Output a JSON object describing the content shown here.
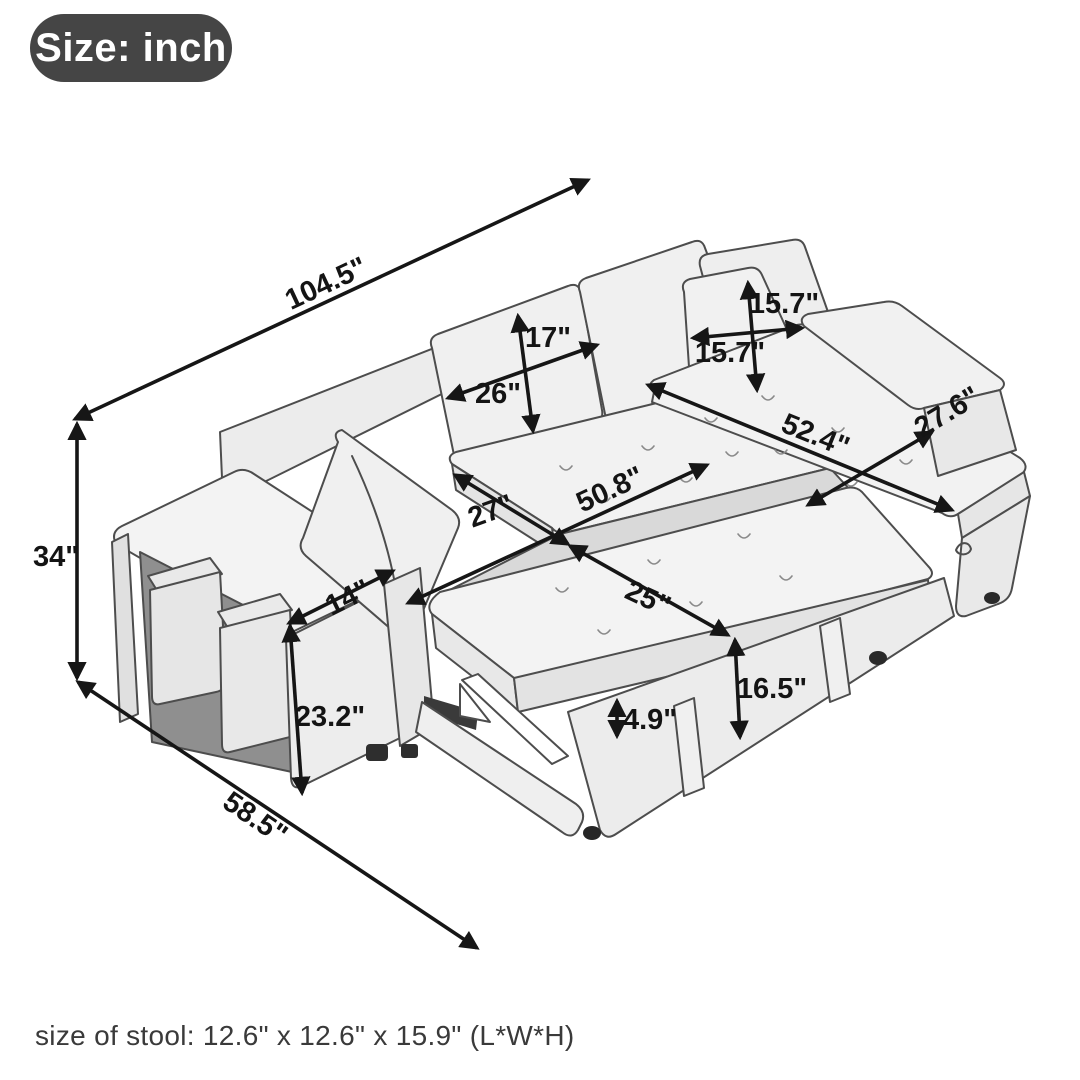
{
  "badge": {
    "label": "Size: inch"
  },
  "footer": {
    "stool_size_note": "size of stool: 12.6\" x 12.6\" x 15.9\" (L*W*H)"
  },
  "dimensions": {
    "total_width": "104.5\"",
    "total_height": "34\"",
    "total_depth": "58.5\"",
    "back_cushion_height": "17\"",
    "back_cushion_width": "26\"",
    "pillow_height": "15.7\"",
    "pillow_width": "15.7\"",
    "chaise_length": "52.4\"",
    "chaise_width": "27.6\"",
    "bed_width": "50.8\"",
    "seat_depth": "27\"",
    "pullout_depth": "25\"",
    "arm_top_width": "14\"",
    "arm_height": "23.2\"",
    "seat_floor_height": "16.5\"",
    "mattress_thickness": "4.9\""
  },
  "colors": {
    "badge_bg": "#454545",
    "badge_text": "#ffffff",
    "arrow": "#161616",
    "sketch_outline": "#4d4d4d",
    "sketch_fill": "#f2f2f2",
    "footer_text": "#3a3a3a"
  }
}
